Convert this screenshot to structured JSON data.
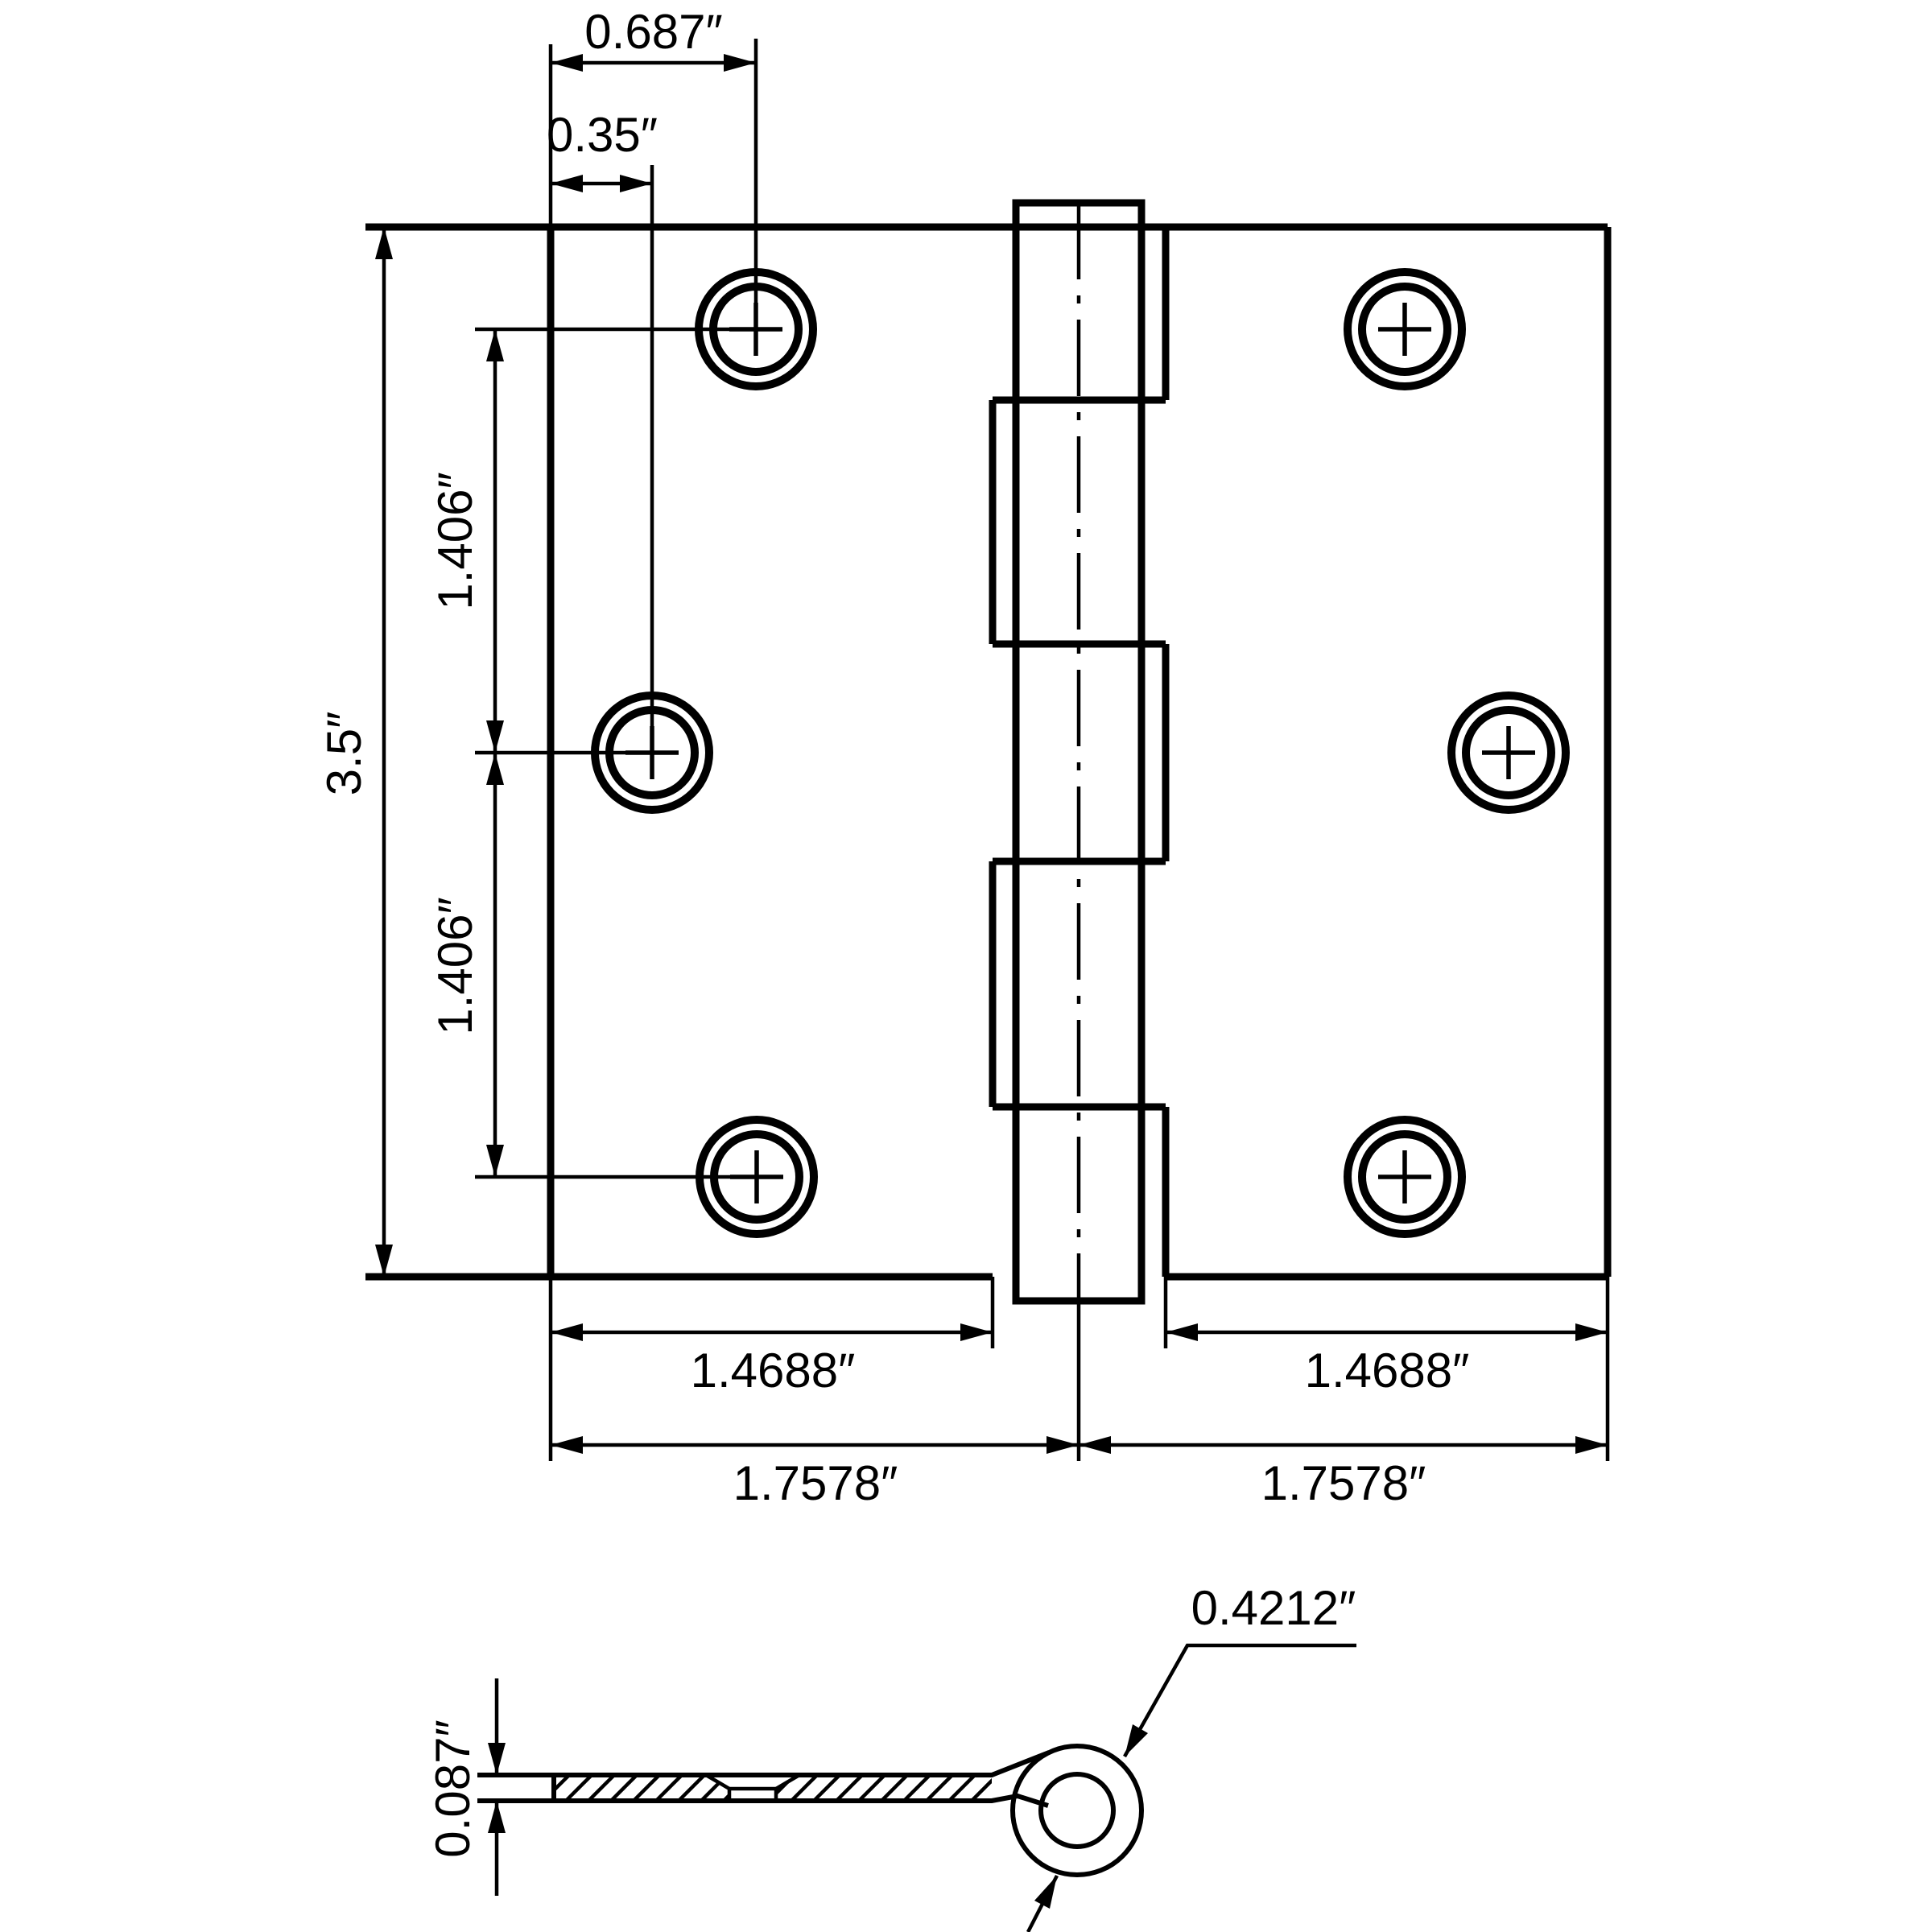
{
  "drawing": {
    "type": "hinge-technical-drawing",
    "front_view": {
      "dimensions": {
        "screw_offset_top": "0.687″",
        "screw_offset_middle": "0.35″",
        "height": "3.5″",
        "screw_spacing_upper": "1.406″",
        "screw_spacing_lower": "1.406″",
        "leaf_width_left": "1.4688″",
        "leaf_width_right": "1.4688″",
        "half_width_left": "1.7578″",
        "half_width_right": "1.7578″"
      },
      "screw_holes": 6,
      "knuckle_segments": 5
    },
    "section_view": {
      "dimensions": {
        "leaf_thickness": "0.087″",
        "knuckle_diameter": "0.4212″"
      }
    },
    "colors": {
      "line": "#000000",
      "background": "#ffffff"
    }
  }
}
